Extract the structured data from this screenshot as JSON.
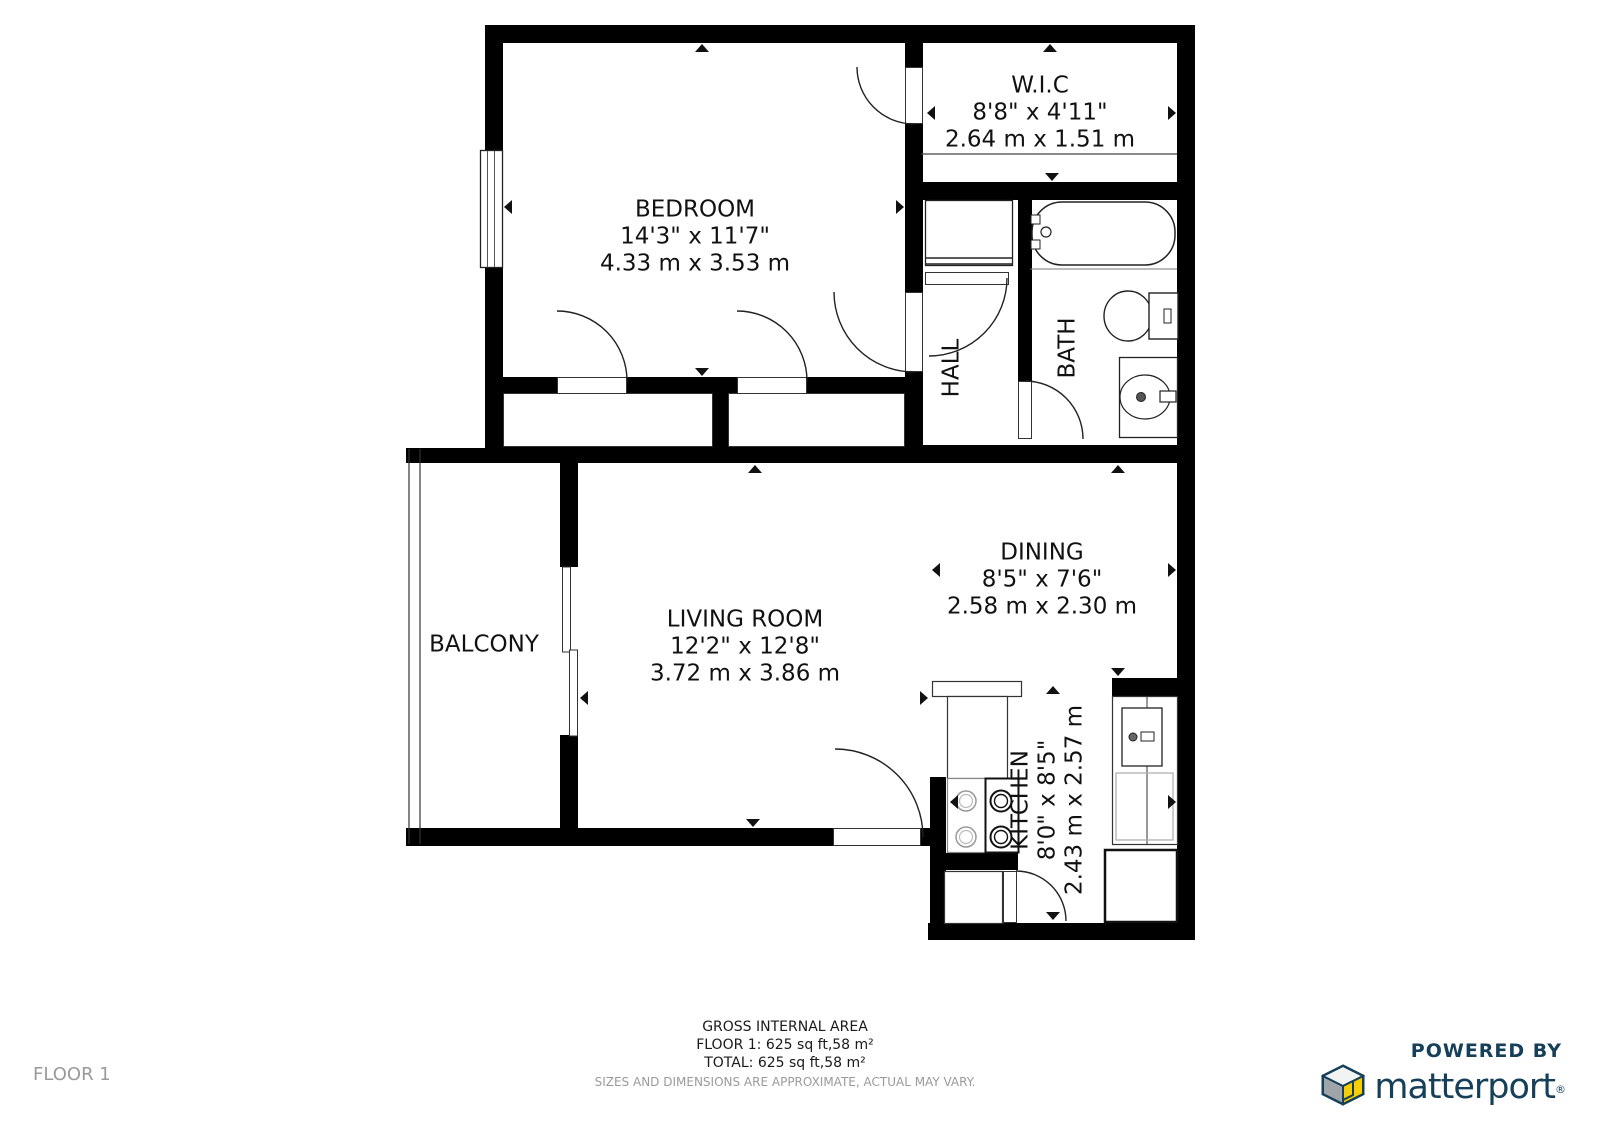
{
  "rooms": [
    {
      "id": "bedroom",
      "name": "BEDROOM",
      "dims_ft": "14'3\" x 11'7\"",
      "dims_m": "4.33 m x 3.53 m"
    },
    {
      "id": "wic",
      "name": "W.I.C",
      "dims_ft": "8'8\" x 4'11\"",
      "dims_m": "2.64 m x 1.51 m"
    },
    {
      "id": "hall",
      "name": "HALL"
    },
    {
      "id": "bath",
      "name": "BATH"
    },
    {
      "id": "dining",
      "name": "DINING",
      "dims_ft": "8'5\" x 7'6\"",
      "dims_m": "2.58 m x 2.30 m"
    },
    {
      "id": "living",
      "name": "LIVING ROOM",
      "dims_ft": "12'2\" x 12'8\"",
      "dims_m": "3.72 m x 3.86 m"
    },
    {
      "id": "balcony",
      "name": "BALCONY"
    },
    {
      "id": "kitchen",
      "name": "KITCHEN",
      "dims_ft": "8'0\" x 8'5\"",
      "dims_m": "2.43 m x 2.57 m"
    }
  ],
  "footer": {
    "area_title": "GROSS INTERNAL AREA",
    "floor_line": "FLOOR 1: 625 sq ft,58 m²",
    "total_line": "TOTAL: 625 sq ft,58 m²",
    "disclaimer": "SIZES AND DIMENSIONS ARE APPROXIMATE, ACTUAL MAY VARY.",
    "floor_label": "FLOOR 1"
  },
  "branding": {
    "powered_by": "POWERED BY",
    "brand": "matterport",
    "registered": "®",
    "brand_color": "#164059",
    "cube_yellow": "#f7ce00",
    "cube_gray": "#9fa4a8"
  }
}
